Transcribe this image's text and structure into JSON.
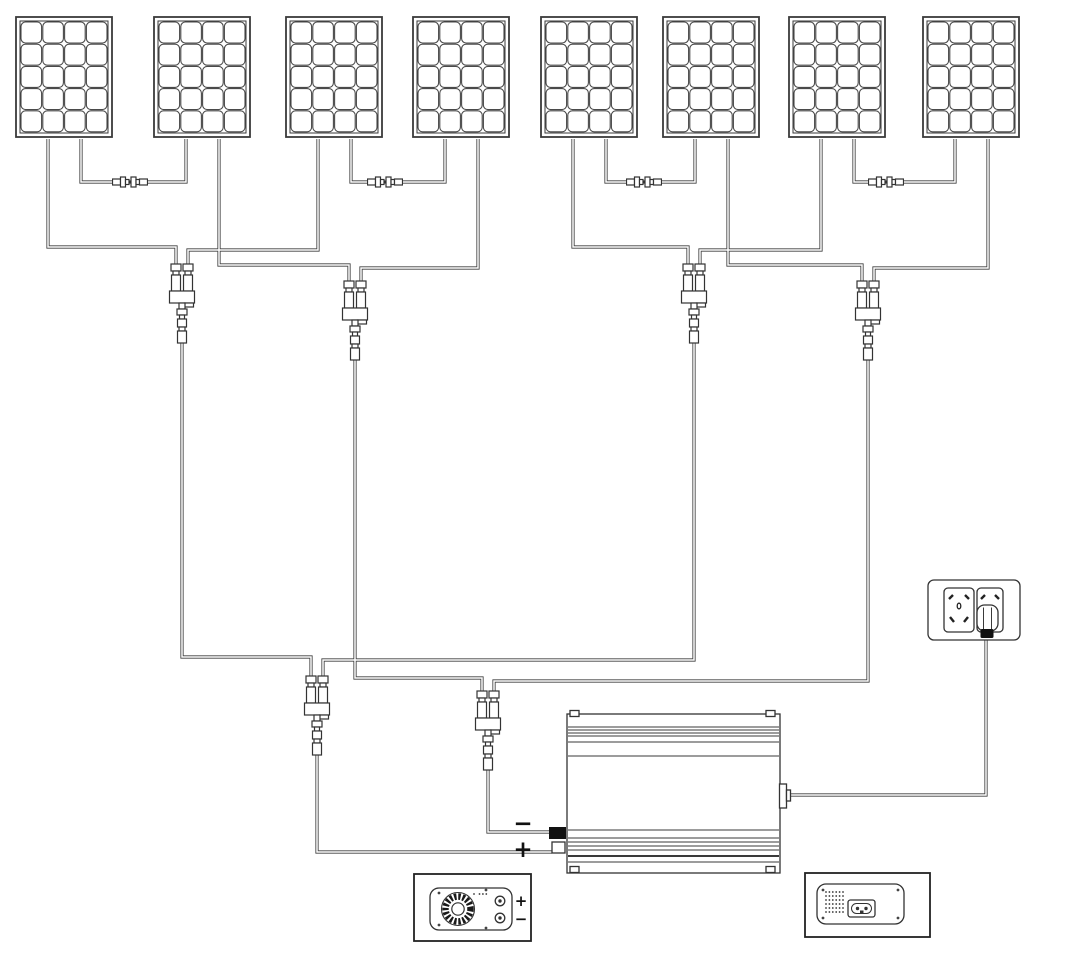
{
  "page": {
    "background": "#ffffff",
    "line_color": "#3f3f3f",
    "component_stroke": "#333333",
    "black_fill": "#111111"
  },
  "labels": {
    "dc_minus": "−",
    "dc_plus": "+",
    "box_plus": "+",
    "box_minus": "−"
  },
  "diagram": {
    "type": "solar-array-wiring-diagram",
    "solar_panel_count": 8,
    "panel_cell_grid": "4x5",
    "series_pair_links": 4,
    "y_branch_combiners": 6,
    "devices": [
      "grid-tie-inverter-top-view",
      "wall-outlet-with-plug",
      "inverter-dc-face-detail",
      "inverter-ac-face-detail"
    ]
  }
}
